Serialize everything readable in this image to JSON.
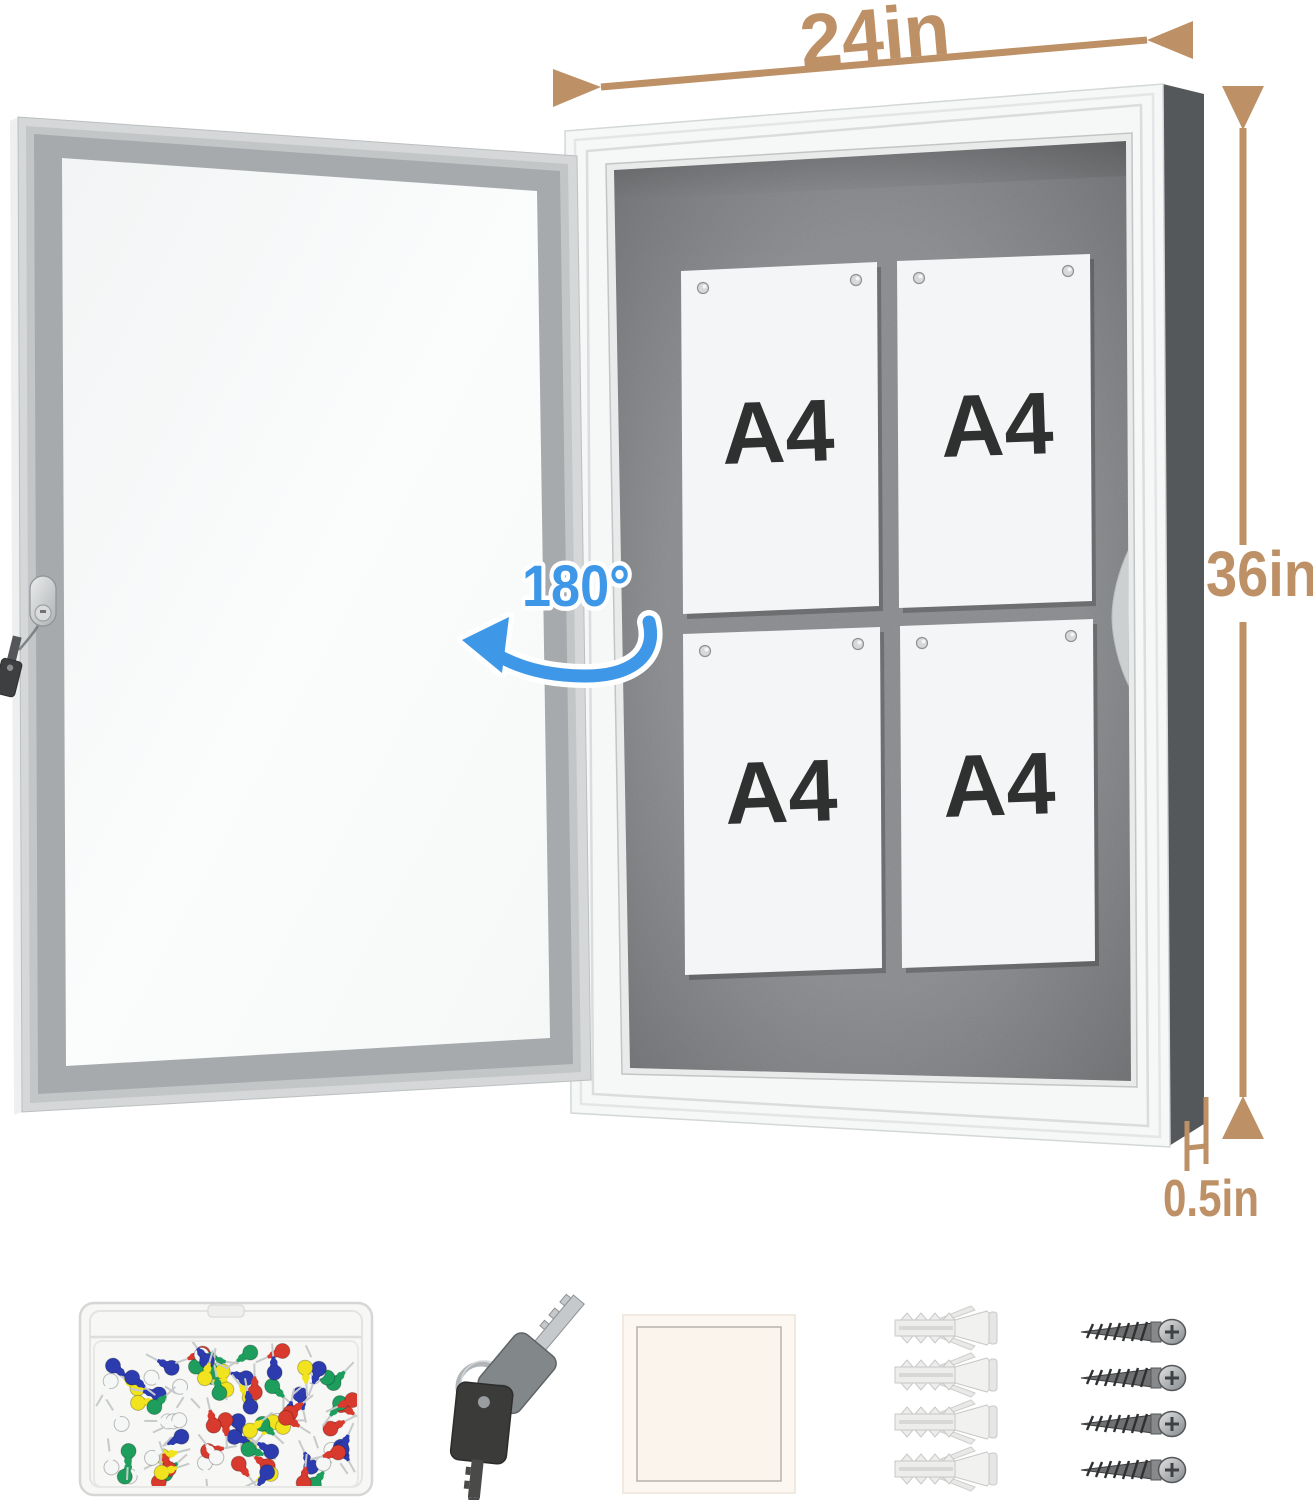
{
  "annotations": {
    "dimension_color": "#bd9066",
    "width": {
      "label": "24in"
    },
    "height": {
      "label": "36in"
    },
    "depth": {
      "label": "0.5in"
    },
    "door_swing": {
      "label": "180°",
      "color": "#3f97e8"
    }
  },
  "board": {
    "felt_color": "#87898c",
    "frame_color": "#f6f7f7",
    "side_color": "#54585b",
    "papers": [
      {
        "label": "A4"
      },
      {
        "label": "A4"
      },
      {
        "label": "A4"
      },
      {
        "label": "A4"
      }
    ]
  },
  "door": {
    "frame_color": "#a7aaad",
    "glass_color": "#fafbfb"
  },
  "accessories": {
    "push_pins": {
      "name": "push-pins-box",
      "pin_colors": [
        "#d93a2e",
        "#2c3cae",
        "#1e9e5c",
        "#f2e31f",
        "#f5f6f6"
      ],
      "pin_count": 84
    },
    "keys": {
      "name": "keys",
      "count": 2
    },
    "pad": {
      "name": "adhesive-pad"
    },
    "anchors": {
      "name": "wall-anchors",
      "count": 4
    },
    "screws": {
      "name": "screws",
      "count": 4
    }
  }
}
